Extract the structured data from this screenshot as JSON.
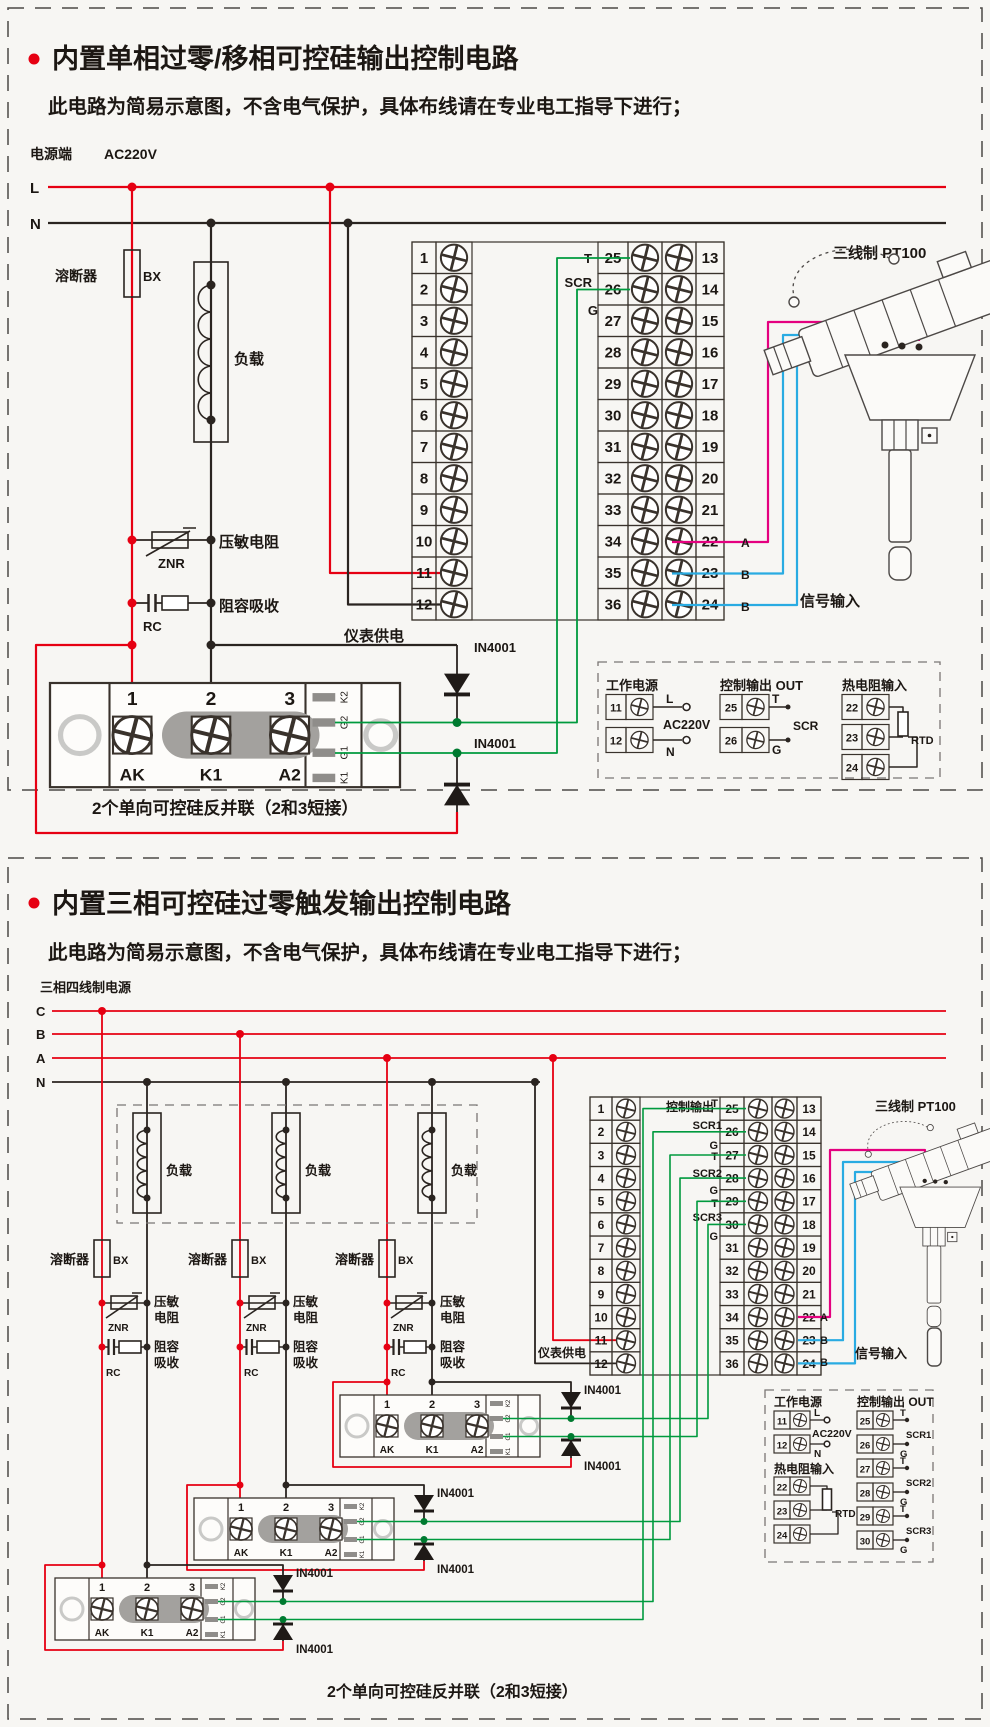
{
  "colors": {
    "accent_red": "#e60012",
    "wire_black": "#2a2420",
    "wire_green": "#009a3e",
    "wire_pink": "#e4007f",
    "wire_blue": "#29abe2"
  },
  "section1": {
    "title": "内置单相过零/移相可控硅输出控制电路",
    "subtitle": "此电路为简易示意图，不含电气保护，具体布线请在专业电工指导下进行；",
    "power_side": "电源端",
    "voltage": "AC220V",
    "line_l": "L",
    "line_n": "N",
    "fuse": "溶断器",
    "fuse_code": "BX",
    "load": "负载",
    "varistor": "压敏电阻",
    "varistor_code": "ZNR",
    "snubber": "阻容吸收",
    "snubber_code": "RC",
    "meter_supply": "仪表供电",
    "t": "T",
    "scr": "SCR",
    "g": "G",
    "sig_a": "A",
    "sig_b1": "B",
    "sig_b2": "B",
    "signal_input": "信号输入",
    "pt100": "三线制 PT100",
    "diode": "IN4001",
    "caption": "2个单向可控硅反并联（2和3短接）"
  },
  "terminals": {
    "c1": [
      "1",
      "2",
      "3",
      "4",
      "5",
      "6",
      "7",
      "8",
      "9",
      "10",
      "11",
      "12"
    ],
    "c25": [
      "25",
      "26",
      "27",
      "28",
      "29",
      "30",
      "31",
      "32",
      "33",
      "34",
      "35",
      "36"
    ],
    "c13": [
      "13",
      "14",
      "15",
      "16",
      "17",
      "18",
      "19",
      "20",
      "21",
      "22",
      "23",
      "24"
    ]
  },
  "module": {
    "t1": "1",
    "t2": "2",
    "t3": "3",
    "n1": "AK",
    "n2": "K1",
    "n3": "A2",
    "s1": "K2",
    "s2": "G2",
    "s3": "G1",
    "s4": "K1"
  },
  "legend1": {
    "power": "工作电源",
    "n11": "11",
    "n12": "12",
    "l": "L",
    "n": "N",
    "v": "AC220V",
    "out": "控制输出 OUT",
    "n25": "25",
    "n26": "26",
    "t": "T",
    "scr": "SCR",
    "g": "G",
    "rtd_in": "热电阻输入",
    "n22": "22",
    "n23": "23",
    "n24": "24",
    "rtd": "RTD"
  },
  "section2": {
    "title": "内置三相可控硅过零触发输出控制电路",
    "subtitle": "此电路为简易示意图，不含电气保护，具体布线请在专业电工指导下进行；",
    "source": "三相四线制电源",
    "line_c": "C",
    "line_b": "B",
    "line_a": "A",
    "line_n": "N",
    "loads": [
      "负载",
      "负载",
      "负载"
    ],
    "fuse": "溶断器",
    "fuse_code": "BX",
    "varistor_l1": "压敏",
    "varistor_l2": "电阻",
    "znr": "ZNR",
    "snub_l1": "阻容",
    "snub_l2": "吸收",
    "rc": "RC",
    "ctrl_out": "控制输出",
    "t": "T",
    "g": "G",
    "scr1": "SCR1",
    "scr2": "SCR2",
    "scr3": "SCR3",
    "meter_supply": "仪表供电",
    "sig_a": "A",
    "sig_b1": "B",
    "sig_b2": "B",
    "signal_input": "信号输入",
    "pt100": "三线制 PT100",
    "diode": "IN4001",
    "caption": "2个单向可控硅反并联（2和3短接）"
  },
  "legend2": {
    "power": "工作电源",
    "n11": "11",
    "n12": "12",
    "l": "L",
    "n": "N",
    "v": "AC220V",
    "rtd_in": "热电阻输入",
    "n22": "22",
    "n23": "23",
    "n24": "24",
    "rtd": "RTD",
    "out": "控制输出 OUT",
    "nums": [
      "25",
      "26",
      "27",
      "28",
      "29",
      "30"
    ],
    "t1": "T",
    "scr1": "SCR1",
    "g1": "G",
    "t2": "T",
    "scr2": "SCR2",
    "g2": "G",
    "t3": "T",
    "scr3": "SCR3",
    "g3": "G"
  }
}
